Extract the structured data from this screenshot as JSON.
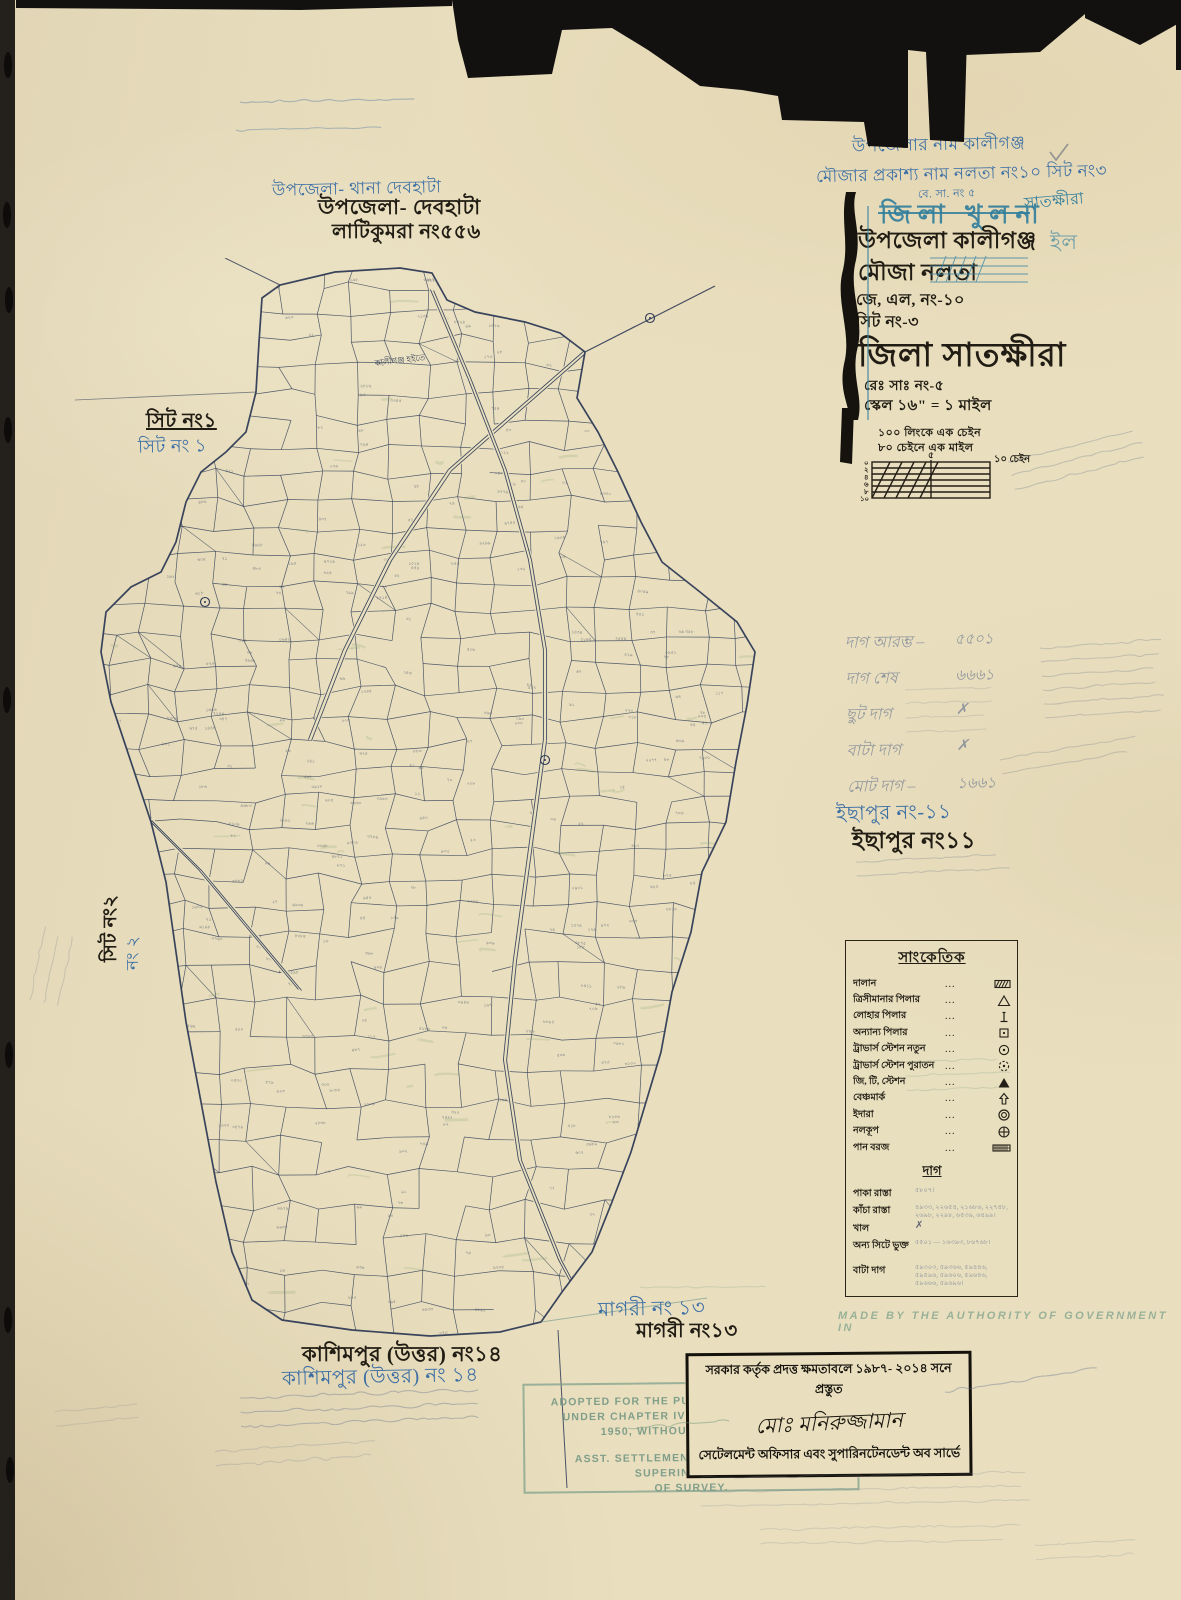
{
  "colors": {
    "paper": "#e9dfbf",
    "ink_black": "#221d14",
    "map_ink": "#2f3b56",
    "hand_blue": "#3c6fa5",
    "stamp_teal": "#2f7d9c",
    "stamp_green": "#76988444",
    "pencil": "#606e8c"
  },
  "top_left": {
    "upazila_blue": "উপজেলা- থানা দেবহাটা",
    "upazila_black": "উপজেলা- দেবহাটা",
    "mouza_black": "লাটিকুমরা নং৫৫৬"
  },
  "header": {
    "line1": "উপজেলার নাম কালীগঞ্জ",
    "line2": "মৌজার প্রকাশ্য নাম নলতা নং১০ সিট নং৩",
    "line2_note": "বে. সা. নং ৫",
    "stamp_district": "জিলা খুলনা",
    "stamp_correction": "সাতক্ষীরা",
    "upazila": "উপজেলা কালীগঞ্জ",
    "upazila_ghost": "ইল",
    "mouza": "মৌজা নলতা",
    "jl": "জে, এল, নং-১০",
    "sheet": "সিট নং-৩",
    "district": "জিলা সাতক্ষীরা",
    "rs": "রেঃ সাঃ নং-৫",
    "scale_line": "স্কেল ১৬\" = ১ মাইল"
  },
  "scale": {
    "note1": "১০০ লিংকে এক চেইন",
    "note2": "৮০ চেইনে এক মাইল",
    "left_ticks": [
      "০",
      "২",
      "৪",
      "৬",
      "৮",
      "১০"
    ],
    "top_mid": "৫",
    "right_label": "১০ চেইন"
  },
  "dag_summary": {
    "rows": [
      {
        "label": "দাগ আরম্ভ –",
        "value": "৫৫০১"
      },
      {
        "label": "দাগ শেষ",
        "value": "৬৬৬১"
      },
      {
        "label": "ছুট দাগ",
        "value": "✗"
      },
      {
        "label": "বাটা দাগ",
        "value": "✗"
      },
      {
        "label": "মোট দাগ –",
        "value": "১৬৬১"
      }
    ]
  },
  "neighbors": {
    "sheet1": {
      "black": "সিট নং১",
      "blue": "সিট নং ১"
    },
    "sheet2": {
      "black": "সিট নং২",
      "blue": "নং ২"
    },
    "ichhapur": {
      "blue": "ইছাপুর নং-১১",
      "black": "ইছাপুর নং১১"
    },
    "magari": {
      "blue": "মাগরী নং ১৩",
      "black": "মাগরী নং১৩"
    },
    "kashimpur": {
      "black": "কাশিমপুর (উত্তর) নং১৪",
      "blue": "কাশিমপুর (উত্তর) নং ১৪"
    }
  },
  "map": {
    "road_label": "কালীগঞ্জ হইতে"
  },
  "legend": {
    "title": "সাংকেতিক",
    "dots": "...",
    "rows": [
      {
        "label": "দালান",
        "symbol": "hatch-rect"
      },
      {
        "label": "ত্রিসীমানার পিলার",
        "symbol": "triangle-open"
      },
      {
        "label": "লোহার পিলার",
        "symbol": "iron-pillar"
      },
      {
        "label": "অন্যান্য পিলার",
        "symbol": "square-dot"
      },
      {
        "label": "ট্রাভার্স স্টেশন নতুন",
        "symbol": "circle-dot"
      },
      {
        "label": "ট্রাভার্স স্টেশন পুরাতন",
        "symbol": "circle-dot-dashed"
      },
      {
        "label": "জি, টি, স্টেশন",
        "symbol": "triangle-filled"
      },
      {
        "label": "বেঞ্চমার্ক",
        "symbol": "benchmark-arrow"
      },
      {
        "label": "ইদারা",
        "symbol": "double-circle"
      },
      {
        "label": "নলকূপ",
        "symbol": "circle-cross"
      },
      {
        "label": "পান বরজ",
        "symbol": "hatch-rect-fine"
      }
    ],
    "dag_title": "দাগ",
    "dag_rows": [
      {
        "label": "পাকা রাস্তা",
        "value": "৫৮০৭।"
      },
      {
        "label": "কাঁচা রাস্তা",
        "value": "৪৯৩৩, ২২৬৫৪, ২১৬৮৬, ২২৭৪৮, ২৬৯৮, ২২৯৮, ৬৫৩৯, ৬৪৯৯।"
      },
      {
        "label": "খাল",
        "value": "✗",
        "dark": true
      },
      {
        "label": "অন্য সিটে ভুক্ত",
        "value": "৫৫০১ — ১৬৩৯৩, ৮৬৭৬৮।"
      },
      {
        "label": "বাটা দাগ",
        "value": "৫৯৩০৩, ৫৯৩৬৬, ৫৯৪৪৬, ৫৯৫৯৬, ৫৯৬০৬, ৫৯৬৪৬, ৫৯৬৬৬, ৫৯৬৯৬।",
        "gap": true
      }
    ]
  },
  "stamps": {
    "made_by": "MADE BY THE AUTHORITY OF GOVERNMENT IN",
    "english": {
      "lines": [
        "ADOPTED FOR THE PURPOSE OF OPERATION",
        "UNDER CHAPTER IV OF THE E.B.S.A. ACT",
        "1950, WITHOUT CORRECTION",
        "ASST. SETTLEMENT OFFICER & ASST. SUPERINTENDENT",
        "OF SURVEY."
      ]
    },
    "bengali": {
      "line1": "সরকার কর্তৃক প্রদত্ত ক্ষমতাবলে ১৯৮৭- ২০১৪ সনে প্রস্তুত",
      "signature": "মোঃ মনিরুজ্জামান",
      "line2": "সেটেলমেন্ট অফিসার এবং সুপারিনটেনডেন্ট অব সার্ভে"
    }
  }
}
